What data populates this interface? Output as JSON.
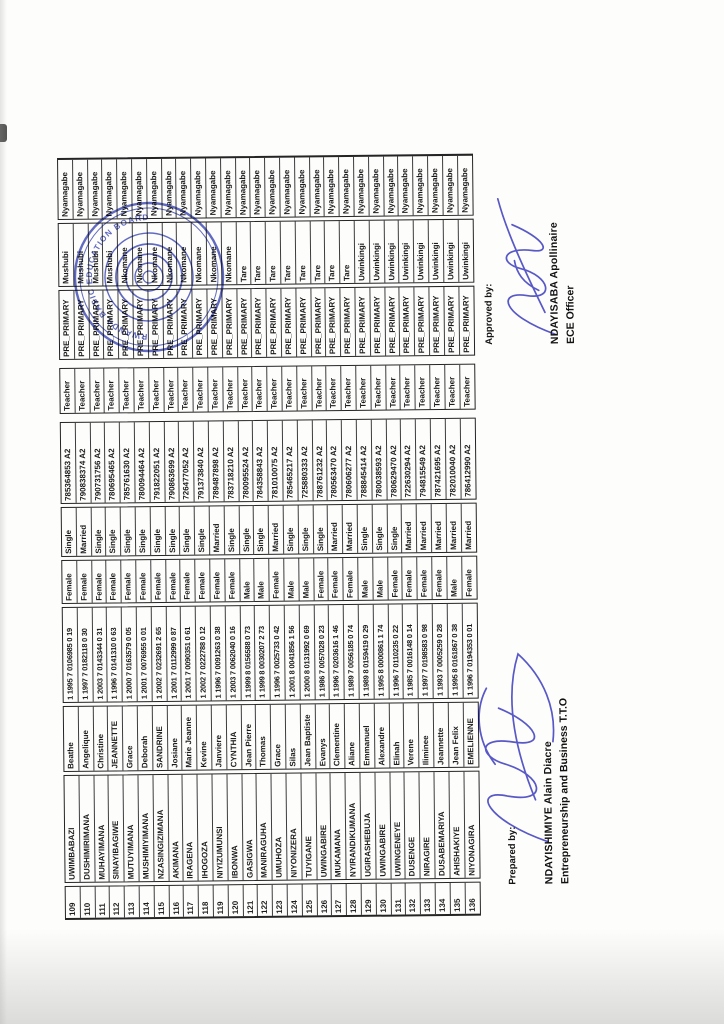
{
  "document": {
    "prepared": {
      "label": "Prepared by:",
      "name": "NDAYISHIMIYE  Alain  Diacre",
      "title": "Entrepreneurship and Business T.T.O"
    },
    "approved": {
      "label": "Approved by:",
      "name": "NDAYISABA  Apollinaire",
      "title": "ECE Officer"
    },
    "stamp": {
      "arc_text": "RWANDA BASIC EDUCATION BOARD",
      "ink_color": "#3a46b5"
    },
    "signature_ink_color": "#3c3cc0"
  },
  "table": {
    "rows": [
      {
        "no": "109",
        "surname": "UWIMBABAZI",
        "firstname": "Beathe",
        "id": "1 1995 7 0106985 0 19",
        "gender": "Female",
        "marital": "Single",
        "phone": "785364853 A2",
        "position": "Teacher",
        "level": "PRE_PRIMARY",
        "sector": "Mushubi",
        "district": "Nyamagabe"
      },
      {
        "no": "110",
        "surname": "DUSHIMIRIMANA",
        "firstname": "Angelique",
        "id": "1 1997 7 0182118 0 30",
        "gender": "Female",
        "marital": "Married",
        "phone": "790838374 A2",
        "position": "Teacher",
        "level": "PRE_PRIMARY",
        "sector": "Mushubi",
        "district": "Nyamagabe"
      },
      {
        "no": "111",
        "surname": "MUHAYIMANA",
        "firstname": "Christine",
        "id": "1 2003 7 0143344 0 31",
        "gender": "Female",
        "marital": "Single",
        "phone": "790731756 A2",
        "position": "Teacher",
        "level": "PRE_PRIMARY",
        "sector": "Mushubi",
        "district": "Nyamagabe"
      },
      {
        "no": "112",
        "surname": "SINAYIBAGIWE",
        "firstname": "JEANNETTE",
        "id": "1 1996 7 0141310 0 63",
        "gender": "Female",
        "marital": "Single",
        "phone": "780695465 A2",
        "position": "Teacher",
        "level": "PRE_PRIMARY",
        "sector": "Mushubi",
        "district": "Nyamagabe"
      },
      {
        "no": "113",
        "surname": "MUTUYIMANA",
        "firstname": "Grace",
        "id": "1 2000 7 0163579 0 05",
        "gender": "Female",
        "marital": "Single",
        "phone": "785761630 A2",
        "position": "Teacher",
        "level": "PRE_PRIMARY",
        "sector": "Nkomane",
        "district": "Nyamagabe"
      },
      {
        "no": "114",
        "surname": "MUSHIMIYIMANA",
        "firstname": "Deborah",
        "id": "1 2001 7 0076955 0 01",
        "gender": "Female",
        "marital": "Single",
        "phone": "780094464 A2",
        "position": "Teacher",
        "level": "PRE_PRIMARY",
        "sector": "Nkomane",
        "district": "Nyamagabe"
      },
      {
        "no": "115",
        "surname": "NZASINGIZIMANA",
        "firstname": "SANDRINE",
        "id": "1 2002 7 0232691 2 65",
        "gender": "Female",
        "marital": "Single",
        "phone": "791822051 A2",
        "position": "Teacher",
        "level": "PRE_PRIMARY",
        "sector": "Nkomane",
        "district": "Nyamagabe"
      },
      {
        "no": "116",
        "surname": "AKIMANA",
        "firstname": "Josiane",
        "id": "1 2001 7 0112999 0 87",
        "gender": "Female",
        "marital": "Single",
        "phone": "790863699 A2",
        "position": "Teacher",
        "level": "PRE_PRIMARY",
        "sector": "Nkomane",
        "district": "Nyamagabe"
      },
      {
        "no": "117",
        "surname": "IRAGENA",
        "firstname": "Marie Jeanne",
        "id": "1 2001 7 0090351 0 61",
        "gender": "Female",
        "marital": "Single",
        "phone": "726477052 A2",
        "position": "Teacher",
        "level": "PRE_PRIMARY",
        "sector": "Nkomane",
        "district": "Nyamagabe"
      },
      {
        "no": "118",
        "surname": "IHOGOZA",
        "firstname": "Kevine",
        "id": "1 2002 7 0222788 0 12",
        "gender": "Female",
        "marital": "Single",
        "phone": "791373840 A2",
        "position": "Teacher",
        "level": "PRE_PRIMARY",
        "sector": "Nkomane",
        "district": "Nyamagabe"
      },
      {
        "no": "119",
        "surname": "NIYIZUMUNSI",
        "firstname": "Janviere",
        "id": "1 1996 7 0091263 0 38",
        "gender": "Female",
        "marital": "Married",
        "phone": "789487898 A2",
        "position": "Teacher",
        "level": "PRE_PRIMARY",
        "sector": "Nkomane",
        "district": "Nyamagabe"
      },
      {
        "no": "120",
        "surname": "IBONWA",
        "firstname": "CYNTHIA",
        "id": "1 2003 7 0062040 0 16",
        "gender": "Female",
        "marital": "Single",
        "phone": "783718210 A2",
        "position": "Teacher",
        "level": "PRE_PRIMARY",
        "sector": "Nkomane",
        "district": "Nyamagabe"
      },
      {
        "no": "121",
        "surname": "GASIGWA",
        "firstname": "Jean Pierre",
        "id": "1 1999 8 0156588 0 73",
        "gender": "Male",
        "marital": "Single",
        "phone": "780095524 A2",
        "position": "Teacher",
        "level": "PRE_PRIMARY",
        "sector": "Tare",
        "district": "Nyamagabe"
      },
      {
        "no": "122",
        "surname": "MANIRAGUHA",
        "firstname": "Thomas",
        "id": "1 1999 8 0030207 2 73",
        "gender": "Male",
        "marital": "Single",
        "phone": "784358843 A2",
        "position": "Teacher",
        "level": "PRE_PRIMARY",
        "sector": "Tare",
        "district": "Nyamagabe"
      },
      {
        "no": "123",
        "surname": "UMUHOZA",
        "firstname": "Grace",
        "id": "1 1996 7 0025733 0 42",
        "gender": "Female",
        "marital": "Married",
        "phone": "781010075 A2",
        "position": "Teacher",
        "level": "PRE_PRIMARY",
        "sector": "Tare",
        "district": "Nyamagabe"
      },
      {
        "no": "124",
        "surname": "NIYONIZERA",
        "firstname": "Silas",
        "id": "1 2001 8 0041856 1 56",
        "gender": "Male",
        "marital": "Single",
        "phone": "785465217 A2",
        "position": "Teacher",
        "level": "PRE_PRIMARY",
        "sector": "Tare",
        "district": "Nyamagabe"
      },
      {
        "no": "125",
        "surname": "TUYIGANE",
        "firstname": "Jean Baptiste",
        "id": "1 2000 8 0131992 0 69",
        "gender": "Male",
        "marital": "Single",
        "phone": "725880333 A2",
        "position": "Teacher",
        "level": "PRE_PRIMARY",
        "sector": "Tare",
        "district": "Nyamagabe"
      },
      {
        "no": "126",
        "surname": "UWINGABIRE",
        "firstname": "Evanys",
        "id": "1 1986 7 0057028 0 23",
        "gender": "Female",
        "marital": "Single",
        "phone": "788761232 A2",
        "position": "Teacher",
        "level": "PRE_PRIMARY",
        "sector": "Tare",
        "district": "Nyamagabe"
      },
      {
        "no": "127",
        "surname": "MUKAMANA",
        "firstname": "Clementine",
        "id": "1 1996 7 0203616 1 46",
        "gender": "Female",
        "marital": "Married",
        "phone": "780563470 A2",
        "position": "Teacher",
        "level": "PRE_PRIMARY",
        "sector": "Tare",
        "district": "Nyamagabe"
      },
      {
        "no": "128",
        "surname": "NYIRANDIKUMANA",
        "firstname": "Aliane",
        "id": "1 1989 7 0056185 0 74",
        "gender": "Female",
        "marital": "Married",
        "phone": "780606277 A2",
        "position": "Teacher",
        "level": "PRE_PRIMARY",
        "sector": "Tare",
        "district": "Nyamagabe"
      },
      {
        "no": "129",
        "surname": "UGIRASHEBUJA",
        "firstname": "Emmanuel",
        "id": "1 1989 8 0159419 0 29",
        "gender": "Male",
        "marital": "Single",
        "phone": "788845414 A2",
        "position": "Teacher",
        "level": "PRE_PRIMARY",
        "sector": "Uwinkingi",
        "district": "Nyamagabe"
      },
      {
        "no": "130",
        "surname": "UWINGABIRE",
        "firstname": "Alexandre",
        "id": "1 1995 8 0000861 1 74",
        "gender": "Male",
        "marital": "Single",
        "phone": "780038593 A2",
        "position": "Teacher",
        "level": "PRE_PRIMARY",
        "sector": "Uwinkingi",
        "district": "Nyamagabe"
      },
      {
        "no": "131",
        "surname": "UWINGENEYE",
        "firstname": "Elinah",
        "id": "1 1996 7 0110235 0 22",
        "gender": "Female",
        "marital": "Single",
        "phone": "780629470 A2",
        "position": "Teacher",
        "level": "PRE_PRIMARY",
        "sector": "Uwinkingi",
        "district": "Nyamagabe"
      },
      {
        "no": "132",
        "surname": "DUSENGE",
        "firstname": "Verene",
        "id": "1 1985 7 0016148 0 14",
        "gender": "Female",
        "marital": "Married",
        "phone": "722630294 A2",
        "position": "Teacher",
        "level": "PRE_PRIMARY",
        "sector": "Uwinkingi",
        "district": "Nyamagabe"
      },
      {
        "no": "133",
        "surname": "NIRAGIRE",
        "firstname": "Iliminee",
        "id": "1 1997 7 0198583 0 98",
        "gender": "Female",
        "marital": "Married",
        "phone": "794815549 A2",
        "position": "Teacher",
        "level": "PRE_PRIMARY",
        "sector": "Uwinkingi",
        "district": "Nyamagabe"
      },
      {
        "no": "134",
        "surname": "DUSABEMARIYA",
        "firstname": "Jeannette",
        "id": "1 1993 7 0005259 0 28",
        "gender": "Female",
        "marital": "Married",
        "phone": "787421695 A2",
        "position": "Teacher",
        "level": "PRE_PRIMARY",
        "sector": "Uwinkingi",
        "district": "Nyamagabe"
      },
      {
        "no": "135",
        "surname": "AHISHAKIYE",
        "firstname": "Jean Felix",
        "id": "1 1995 8 0161867 0 38",
        "gender": "Male",
        "marital": "Married",
        "phone": "782010040 A2",
        "position": "Teacher",
        "level": "PRE_PRIMARY",
        "sector": "Uwinkingi",
        "district": "Nyamagabe"
      },
      {
        "no": "136",
        "surname": "NIYONAGIRA",
        "firstname": "EMELIENNE",
        "id": "1 1996 7 0194353 0 01",
        "gender": "Female",
        "marital": "Married",
        "phone": "786412990 A2",
        "position": "Teacher",
        "level": "PRE_PRIMARY",
        "sector": "Uwinkingi",
        "district": "Nyamagabe"
      }
    ]
  }
}
